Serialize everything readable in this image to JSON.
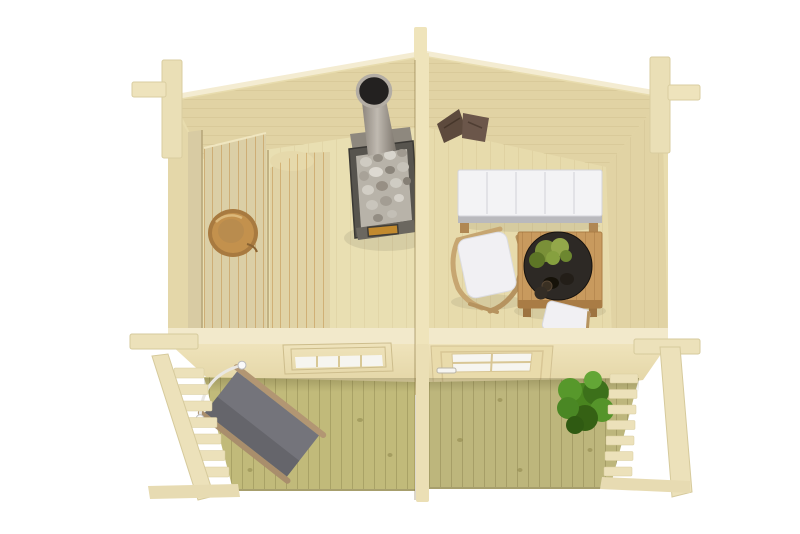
{
  "meta": {
    "title": "Log cabin with sauna, lounge and front terrace — top-down cutaway 3D render",
    "view": "top-down cutaway product render",
    "background": "#ffffff"
  },
  "palette": {
    "background": "#ffffff",
    "wall_cream": "#e8dcae",
    "wall_light": "#f2e9cb",
    "wall_shade": "#e1d3a4",
    "divider": "#efe4bb",
    "front_face": "#e7daab",
    "floor_sauna": "#e9dfb2",
    "floor_lounge": "#e7dbac",
    "bench_wood": "#dbcfa6",
    "bench_lower": "#e0d3a6",
    "backrest": "#d8cba3",
    "bucket_wood": "#c3914d",
    "stove_body": "#57544e",
    "stove_stones": "#b8b3a9",
    "stove_pipe": "#a49e96",
    "pipe_mouth": "#232120",
    "fire_glass": "#c28a2e",
    "towel_brown": "#5d4a3d",
    "sofa_white": "#f3f3f5",
    "sofa_trim": "#b9b9bd",
    "chair_white": "#f1f0f3",
    "frame_wood": "#c7a671",
    "table_wood": "#c89a5e",
    "bowl_dark": "#2d2925",
    "greens": "#7a9038",
    "deck_left": "#c1ba7a",
    "deck_right": "#bdb67c",
    "rail_cream": "#ece1ba",
    "lounger_gray": "#74747b",
    "lounger_frame": "#b29673",
    "plant_green": "#49851f",
    "glass_white": "#f6f5f0"
  },
  "scene": {
    "building": "log cabin (44 mm timber look)",
    "rooms": [
      {
        "name": "sauna",
        "position": "left",
        "items": [
          "two-tier bench",
          "backrest board",
          "wooden bucket",
          "wood-burning stove with stones",
          "stainless chimney pipe"
        ]
      },
      {
        "name": "lounge",
        "position": "right",
        "items": [
          "white bench sofa with five cushions",
          "white folding chair",
          "square slatted wooden table",
          "dark bowl with greenery",
          "white stool",
          "two brown towels on floor"
        ]
      },
      {
        "name": "terrace",
        "position": "front",
        "items": [
          "grey fabric sun lounger",
          "green shrub",
          "left slatted railing",
          "right slatted railing"
        ]
      }
    ],
    "structure": [
      "gabled back wall",
      "central divider wall",
      "front wall with 4-pane window",
      "front wall with panelled glass door",
      "corner log joints",
      "vertical deck boards"
    ]
  }
}
